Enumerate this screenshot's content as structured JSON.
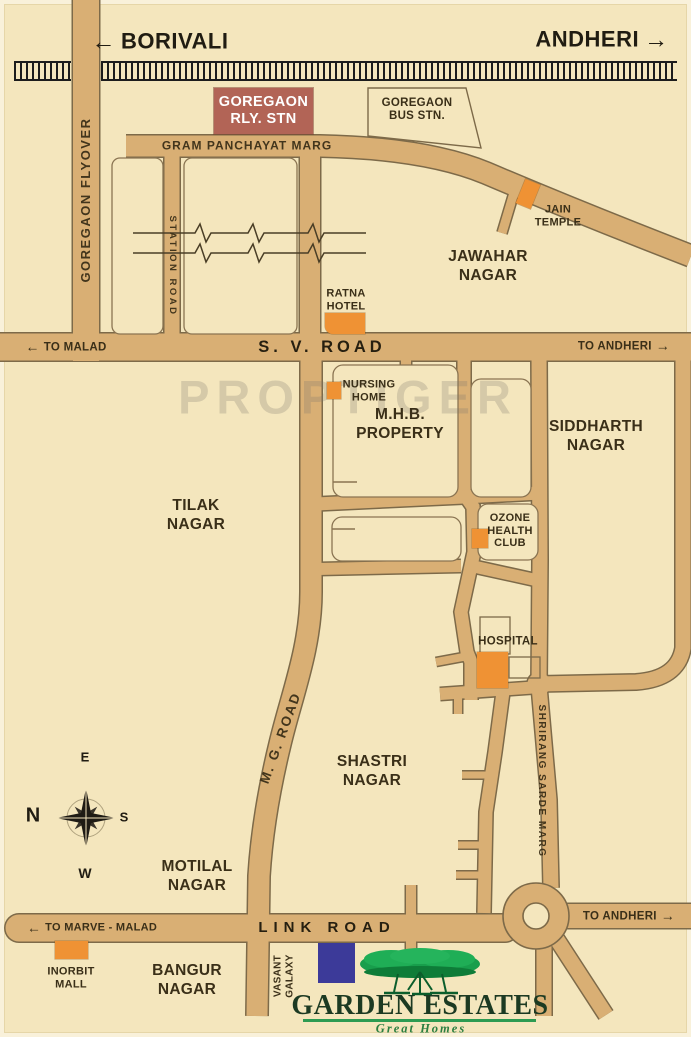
{
  "colors": {
    "background": "#f4e6bd",
    "road_fill": "#d9af74",
    "road_outline": "#7d6a49",
    "landmark_orange": "#ef9234",
    "station_maroon": "#b26456",
    "vasant_navy": "#3c3a99",
    "tree_green": "#189e4c",
    "logo_text_green": "#1c3a22",
    "railway_black": "#1c1c1c"
  },
  "top": {
    "borivali": "BORIVALI",
    "andheri": "ANDHERI",
    "left_arrow": "←",
    "right_arrow": "→"
  },
  "stations": {
    "railway": "GOREGAON\nRLY. STN",
    "bus": "GOREGAON\nBUS STN."
  },
  "roads": {
    "gram_panchayat_marg": "GRAM PANCHAYAT MARG",
    "goregaon_flyover": "GOREGAON FLYOVER",
    "station_road": "STATION ROAD",
    "sv_road": "S. V. ROAD",
    "mg_road": "M. G. ROAD",
    "link_road": "LINK ROAD",
    "shrirang_sarde_marg": "SHRIRANG SARDE MARG"
  },
  "directions": {
    "to_malad": "TO MALAD",
    "to_andheri_sv": "TO ANDHERI",
    "to_marve_malad": "TO MARVE - MALAD",
    "to_andheri_link": "TO ANDHERI"
  },
  "areas": {
    "jawahar": "JAWAHAR\nNAGAR",
    "siddharth": "SIDDHARTH\nNAGAR",
    "tilak": "TILAK\nNAGAR",
    "mhb": "M.H.B.\nPROPERTY",
    "shastri": "SHASTRI\nNAGAR",
    "motilal": "MOTILAL\nNAGAR",
    "bangur": "BANGUR\nNAGAR"
  },
  "landmarks": {
    "jain_temple": "JAIN\nTEMPLE",
    "ratna_hotel": "RATNA\nHOTEL",
    "nursing_home": "NURSING\nHOME",
    "ozone_health_club": "OZONE\nHEALTH\nCLUB",
    "hospital": "HOSPITAL",
    "inorbit_mall": "INORBIT\nMALL",
    "vasant_galaxy": "VASANT\nGALAXY"
  },
  "compass": {
    "n": "N",
    "e": "E",
    "s": "S",
    "w": "W"
  },
  "logo": {
    "name": "GARDEN ESTATES",
    "tagline": "Great Homes"
  },
  "watermark": "PROPTIGER"
}
